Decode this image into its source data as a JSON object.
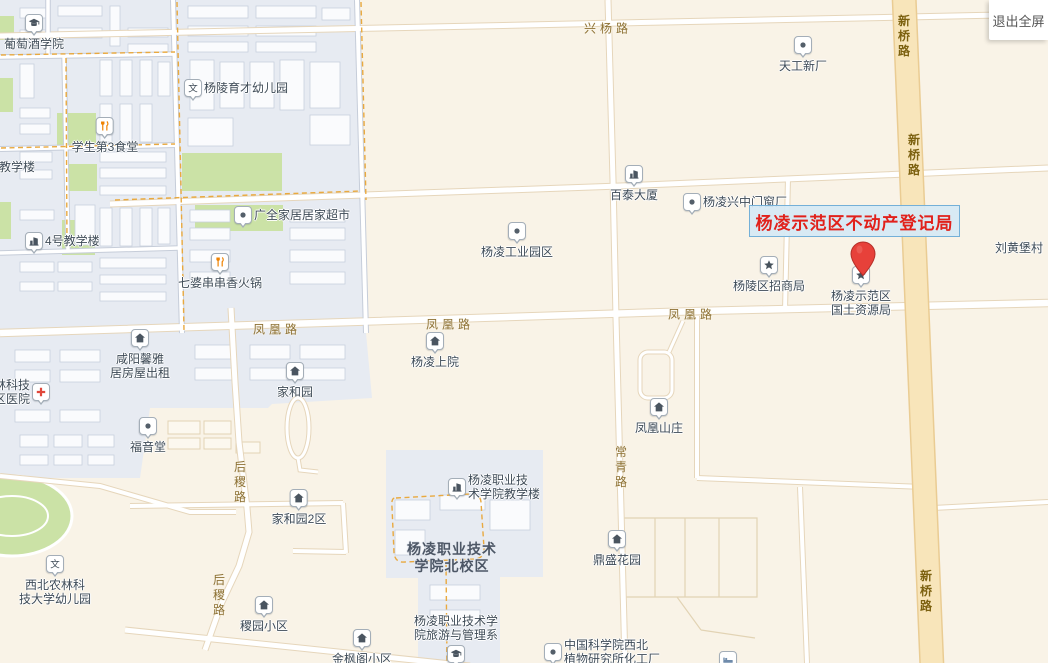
{
  "fullscreen_button": {
    "label": "退出全屏"
  },
  "title_overlay": {
    "text": "杨凌示范区不动产登记局",
    "text_color": "#e1211b",
    "box_border": "#74b0d8",
    "box_fill": "#d5e9f5"
  },
  "marker": {
    "name_lines": [
      "杨凌示范区",
      "国土资源局"
    ],
    "pin_color": "#e7413a"
  },
  "map": {
    "colors": {
      "background": "#f9f3e7",
      "campus_area": "#e7ebf2",
      "green_area": "#cbe2a6",
      "road_fill": "#ffffff",
      "road_casing": "#e6d6bb",
      "major_road_fill": "#f8e5ba",
      "major_road_casing": "#eacc93",
      "poi_text": "#3e4b57",
      "road_text": "#8d7134"
    },
    "road_labels": [
      {
        "text": "兴杨路",
        "x": 608,
        "y": 28,
        "vertical": false,
        "yellow": false,
        "spaced": true
      },
      {
        "text": "新桥路",
        "x": 904,
        "y": 37,
        "vertical": true,
        "yellow": true,
        "spaced": false
      },
      {
        "text": "新桥路",
        "x": 914,
        "y": 156,
        "vertical": true,
        "yellow": true,
        "spaced": false
      },
      {
        "text": "新桥路",
        "x": 926,
        "y": 592,
        "vertical": true,
        "yellow": true,
        "spaced": false
      },
      {
        "text": "凤凰路",
        "x": 277,
        "y": 329,
        "vertical": false,
        "yellow": false,
        "spaced": true
      },
      {
        "text": "凤凰路",
        "x": 450,
        "y": 324,
        "vertical": false,
        "yellow": false,
        "spaced": true
      },
      {
        "text": "凤凰路",
        "x": 692,
        "y": 314,
        "vertical": false,
        "yellow": false,
        "spaced": true
      },
      {
        "text": "后稷路",
        "x": 240,
        "y": 483,
        "vertical": true,
        "yellow": false,
        "spaced": false
      },
      {
        "text": "后稷路",
        "x": 219,
        "y": 596,
        "vertical": true,
        "yellow": false,
        "spaced": false
      },
      {
        "text": "常青路",
        "x": 621,
        "y": 468,
        "vertical": true,
        "yellow": false,
        "spaced": false
      }
    ],
    "pois": [
      {
        "name": "grape-wine-college",
        "lines": [
          "葡萄酒学院"
        ],
        "icon": "gradcap",
        "layout": "icon-top",
        "x": 34,
        "y": 22
      },
      {
        "name": "yangling-yucai-kindergarten",
        "lines": [
          "杨陵育才幼儿园"
        ],
        "icon": "wen",
        "layout": "icon-left",
        "x": 192,
        "y": 88
      },
      {
        "name": "student-canteen-3",
        "lines": [
          "学生第3食堂"
        ],
        "icon": "restaurant",
        "layout": "icon-top",
        "x": 105,
        "y": 125
      },
      {
        "name": "teaching-building-partial",
        "lines": [
          "教学楼"
        ],
        "icon": null,
        "layout": "text-only",
        "x": 17,
        "y": 167
      },
      {
        "name": "teaching-building-4",
        "lines": [
          "4号教学楼"
        ],
        "icon": "building",
        "layout": "icon-left",
        "x": 33,
        "y": 241
      },
      {
        "name": "guangquan-home-supermarket",
        "lines": [
          "广全家居居家超市"
        ],
        "icon": "dot",
        "layout": "icon-left",
        "x": 242,
        "y": 215
      },
      {
        "name": "qipo-hotpot",
        "lines": [
          "七婆串串香火锅"
        ],
        "icon": "restaurant",
        "layout": "icon-top",
        "x": 220,
        "y": 261
      },
      {
        "name": "tiangong-new-factory",
        "lines": [
          "天工新厂"
        ],
        "icon": "dot",
        "layout": "icon-top",
        "x": 803,
        "y": 44
      },
      {
        "name": "baitai-building",
        "lines": [
          "百泰大厦"
        ],
        "icon": "building",
        "layout": "icon-top",
        "x": 634,
        "y": 173
      },
      {
        "name": "xingzhong-door-window-factory",
        "lines": [
          "杨凌兴中门窗厂"
        ],
        "icon": "dot",
        "layout": "icon-left",
        "x": 691,
        "y": 202
      },
      {
        "name": "yangling-industrial-park",
        "lines": [
          "杨凌工业园区"
        ],
        "icon": "dot",
        "layout": "icon-top",
        "x": 517,
        "y": 230
      },
      {
        "name": "yangling-investment-bureau",
        "lines": [
          "杨陵区招商局"
        ],
        "icon": "star",
        "layout": "icon-top",
        "x": 769,
        "y": 264
      },
      {
        "name": "liuhuangbu-village",
        "lines": [
          "刘黄堡村"
        ],
        "icon": null,
        "layout": "text-only",
        "x": 1019,
        "y": 248
      },
      {
        "name": "xianyang-xinya-rental",
        "lines": [
          "咸阳馨雅",
          "居房屋出租"
        ],
        "icon": "home",
        "layout": "icon-top",
        "x": 140,
        "y": 337
      },
      {
        "name": "jiaheyuan",
        "lines": [
          "家和园"
        ],
        "icon": "home",
        "layout": "icon-top",
        "x": 295,
        "y": 370
      },
      {
        "name": "yangling-shangyuan",
        "lines": [
          "杨凌上院"
        ],
        "icon": "home",
        "layout": "icon-top",
        "x": 435,
        "y": 340
      },
      {
        "name": "fenghuang-villa",
        "lines": [
          "凤凰山庄"
        ],
        "icon": "home",
        "layout": "icon-top",
        "x": 659,
        "y": 406
      },
      {
        "name": "district-hospital-partial",
        "lines": [
          "林科技",
          "区医院"
        ],
        "icon": "hospital",
        "layout": "icon-right",
        "x": 42,
        "y": 392
      },
      {
        "name": "fuyintang-church",
        "lines": [
          "福音堂"
        ],
        "icon": "dot",
        "layout": "icon-top",
        "x": 148,
        "y": 425
      },
      {
        "name": "jiaheyuan-2",
        "lines": [
          "家和园2区"
        ],
        "icon": "home",
        "layout": "icon-top",
        "x": 299,
        "y": 497
      },
      {
        "name": "nwafu-kindergarten",
        "lines": [
          "西北农林科",
          "技大学幼儿园"
        ],
        "icon": "wen",
        "layout": "icon-top",
        "x": 55,
        "y": 563
      },
      {
        "name": "jiyuan-community",
        "lines": [
          "稷园小区"
        ],
        "icon": "home",
        "layout": "icon-top",
        "x": 264,
        "y": 604
      },
      {
        "name": "jinfengge-community",
        "lines": [
          "金枫阁小区"
        ],
        "icon": "home",
        "layout": "icon-top",
        "x": 362,
        "y": 637
      },
      {
        "name": "dingsheng-garden",
        "lines": [
          "鼎盛花园"
        ],
        "icon": "home",
        "layout": "icon-top",
        "x": 617,
        "y": 538
      },
      {
        "name": "vocational-college-teaching-building",
        "lines": [
          "杨凌职业技",
          "术学院教学楼"
        ],
        "icon": "building",
        "layout": "icon-left",
        "x": 456,
        "y": 487
      },
      {
        "name": "vocational-college-north-campus",
        "lines": [
          "杨凌职业技术",
          "学院北校区"
        ],
        "icon": null,
        "layout": "text-only",
        "campus": true,
        "x": 452,
        "y": 558
      },
      {
        "name": "tourism-management-dept",
        "lines": [
          "杨凌职业技术学",
          "院旅游与管理系"
        ],
        "icon": "gradcap",
        "layout": "icon-bottom",
        "x": 456,
        "y": 653
      },
      {
        "name": "cas-northwest-botany-plant",
        "lines": [
          "中国科学院西北",
          "植物研究所化工厂"
        ],
        "icon": "dot",
        "layout": "icon-left",
        "x": 552,
        "y": 652
      },
      {
        "name": "land-resources-bureau",
        "lines": [
          "杨凌示范区",
          "国土资源局"
        ],
        "icon": "star",
        "layout": "icon-top",
        "x": 861,
        "y": 274
      },
      {
        "name": "hotel-partial",
        "lines": [],
        "icon": "bed",
        "layout": "icon-only",
        "x": 727,
        "y": 659
      }
    ]
  }
}
